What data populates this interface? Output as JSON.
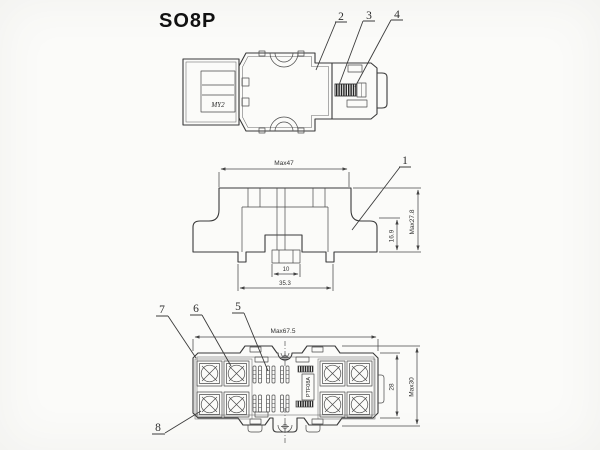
{
  "title": "SO8P",
  "colors": {
    "ink": "#3a3a3a",
    "paper": "#fbfbf9"
  },
  "top_view": {
    "relay_label": "MY2",
    "callouts": {
      "c2": "2",
      "c3": "3",
      "c4": "4"
    }
  },
  "side_view": {
    "callouts": {
      "c1": "1"
    },
    "dims": {
      "overall_width": "Max47",
      "overall_height": "Max27.8",
      "body_height": "16.9",
      "clip_width": "10",
      "base_width": "35.3"
    }
  },
  "bottom_view": {
    "socket_label": "PTF08A",
    "callouts": {
      "c5": "5",
      "c6": "6",
      "c7": "7",
      "c8": "8"
    },
    "dims": {
      "overall_width": "Max67.5",
      "inner_height": "28",
      "overall_height": "Max30"
    }
  }
}
